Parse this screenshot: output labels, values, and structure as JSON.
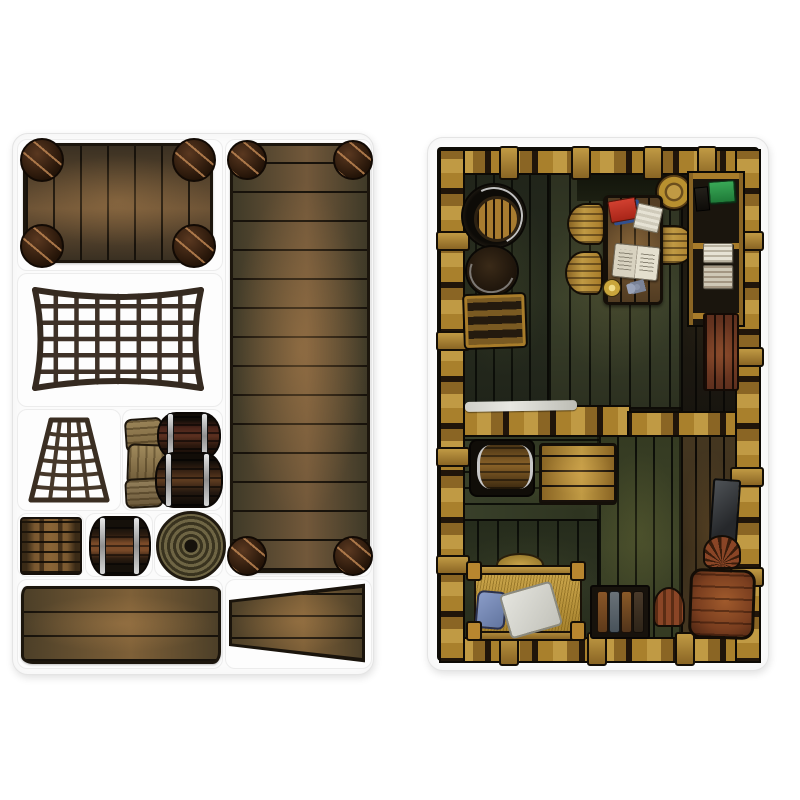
{
  "scene": {
    "type": "product-photo",
    "description": "Two die-cut cardboard punch-out sheets for a pirate-ship tabletop game: a terrain accessories sheet (rafts, nets, barrels, crates, rope, gangplanks) and a ship's cabin map tile with furniture",
    "background_color": "#ffffff",
    "sheet_color": "#fbfbfb"
  },
  "left_sheet": {
    "name": "Terrain accessories punch-out sheet",
    "pieces": [
      {
        "id": "small-raft",
        "label": "Small raft with barrel floats"
      },
      {
        "id": "long-raft",
        "label": "Long raft with barrel floats"
      },
      {
        "id": "cargo-net",
        "label": "Cargo net"
      },
      {
        "id": "rigging-net",
        "label": "Rigging net"
      },
      {
        "id": "sacks-and-barrels",
        "label": "Grain sacks with stacked barrels"
      },
      {
        "id": "crate",
        "label": "Wooden crate"
      },
      {
        "id": "barrel",
        "label": "Barrel on its side"
      },
      {
        "id": "rope-coil",
        "label": "Coiled rope"
      },
      {
        "id": "gangplank",
        "label": "Gangplank"
      },
      {
        "id": "tapered-gangplank",
        "label": "Tapered gangplank"
      }
    ]
  },
  "right_sheet": {
    "name": "Ship's cabin map tile",
    "features": [
      {
        "id": "open-barrel",
        "label": "Open barrel (top view)"
      },
      {
        "id": "closed-barrel",
        "label": "Closed barrel (top view)"
      },
      {
        "id": "bottle-crate",
        "label": "Crate of bottles"
      },
      {
        "id": "captains-table",
        "label": "Captain's table"
      },
      {
        "id": "chair-top-left",
        "label": "Wooden chair"
      },
      {
        "id": "chair-bottom-left",
        "label": "Wooden chair"
      },
      {
        "id": "keg-stool",
        "label": "Keg stool"
      },
      {
        "id": "chair-right",
        "label": "Wooden chair"
      },
      {
        "id": "red-book",
        "label": "Red book on blue book"
      },
      {
        "id": "folded-paper",
        "label": "Folded papers"
      },
      {
        "id": "open-chart",
        "label": "Open sea chart"
      },
      {
        "id": "candle-plate",
        "label": "Candle on a plate"
      },
      {
        "id": "keys",
        "label": "Ring of keys"
      },
      {
        "id": "shelf-unit",
        "label": "Wall shelf unit"
      },
      {
        "id": "green-book",
        "label": "Green book"
      },
      {
        "id": "lantern",
        "label": "Dark lantern"
      },
      {
        "id": "paper-stack-top",
        "label": "Stack of papers"
      },
      {
        "id": "paper-stack-bottom",
        "label": "Stack of parchment"
      },
      {
        "id": "red-cabinet",
        "label": "Red cabinet"
      },
      {
        "id": "slate-panel",
        "label": "Slate panel"
      },
      {
        "id": "partition-wall",
        "label": "Partition wall"
      },
      {
        "id": "wall-cloth",
        "label": "Cloth on partition wall"
      },
      {
        "id": "cross-beam",
        "label": "Cross beam"
      },
      {
        "id": "barrel-rack",
        "label": "Barrel in rack"
      },
      {
        "id": "storage-chest",
        "label": "Storage chest"
      },
      {
        "id": "bed",
        "label": "Bunk with straw mattress"
      },
      {
        "id": "pillow",
        "label": "Blue pillow"
      },
      {
        "id": "blanket",
        "label": "White blanket"
      },
      {
        "id": "bottle-shelf",
        "label": "Shelf with bottles"
      },
      {
        "id": "small-red-chair",
        "label": "Small chair"
      },
      {
        "id": "red-table",
        "label": "Red table"
      },
      {
        "id": "spindle-chair",
        "label": "Spindle-back chair"
      }
    ]
  },
  "palette": {
    "background": "#ffffff",
    "sheet": "#fbfbfb",
    "die_cut_line": "#e9e9e9",
    "ink_outline": "#1c160d",
    "wood_dark": "#2e2618",
    "wood_mid": "#5c4a2e",
    "wood_light": "#8a6a42",
    "frame_gold": "#b88c34",
    "floor_green": "#343a26",
    "rope_brown": "#3e3127",
    "sack_tan": "#8f7a50",
    "metal_silver": "#c0c0c0",
    "book_red": "#c23425",
    "book_blue": "#31508e",
    "book_green": "#2f9147",
    "paper_cream": "#e6e2d4",
    "straw_yellow": "#c9a44a",
    "pillow_blue": "#7587ba",
    "blanket_white": "#d8d8d2",
    "table_red": "#7a3e1f"
  }
}
